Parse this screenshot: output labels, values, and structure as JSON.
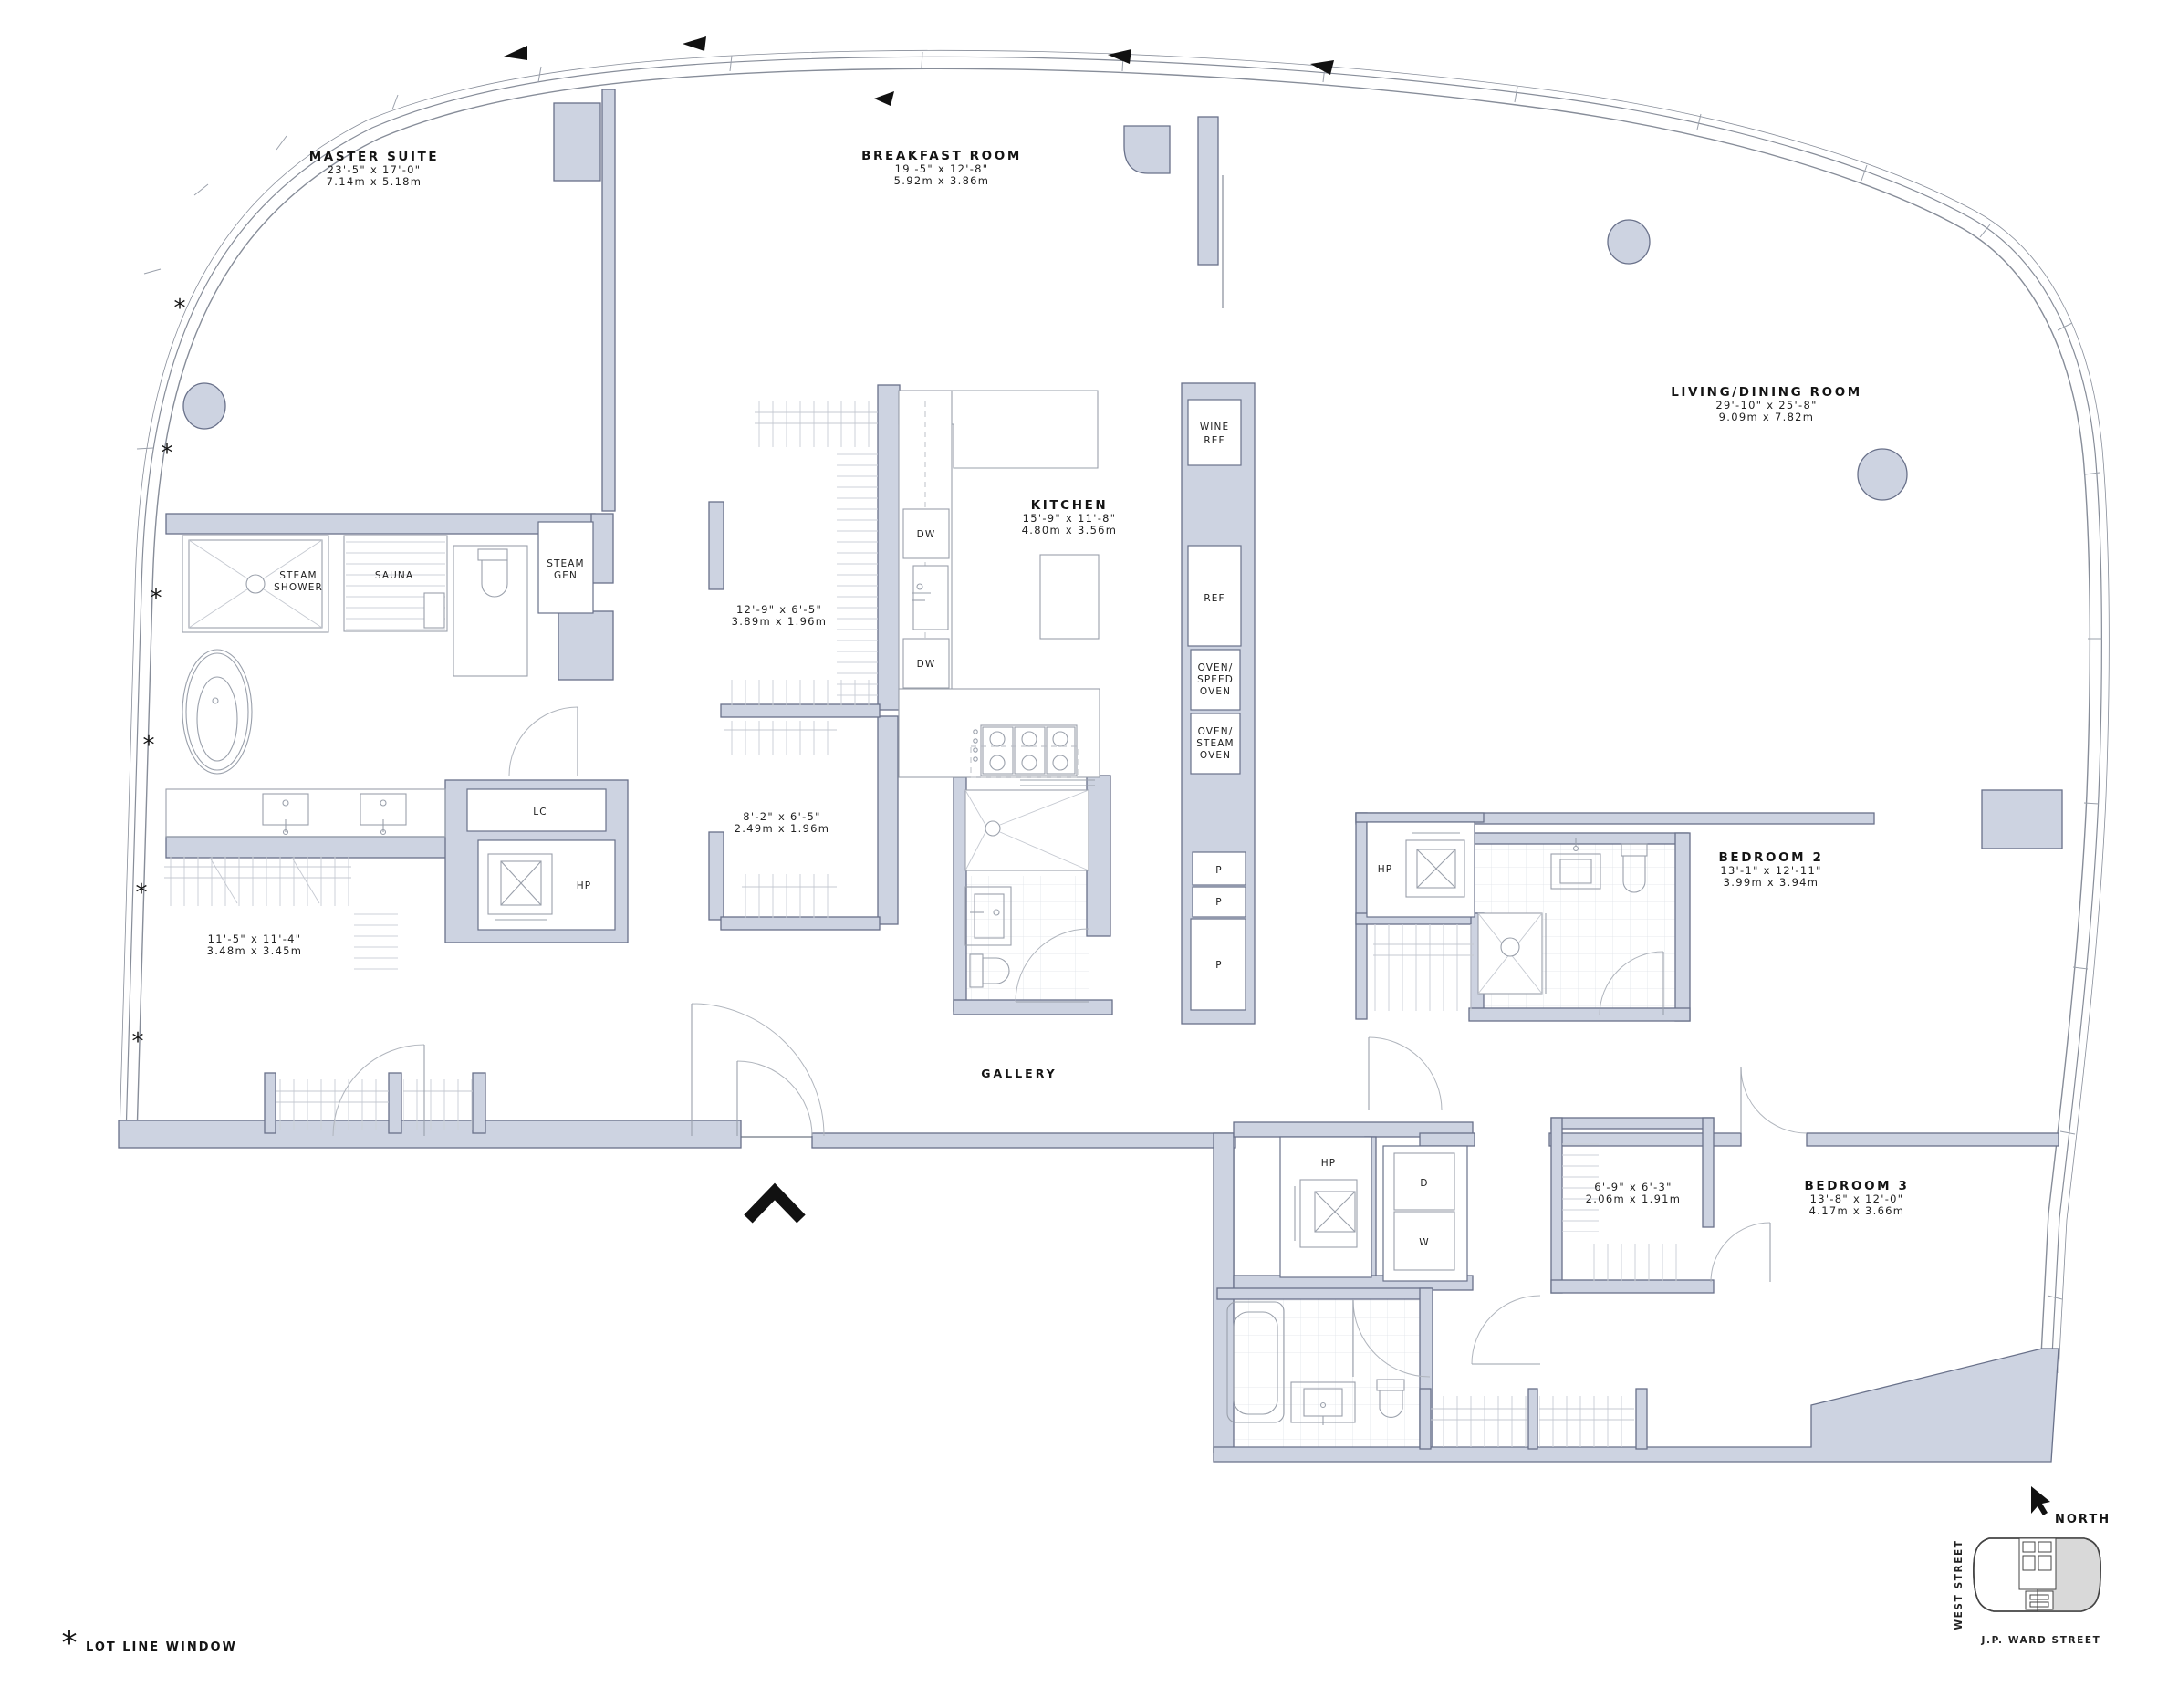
{
  "rooms": {
    "master_suite": {
      "name": "MASTER SUITE",
      "imperial": "23'-5\" x 17'-0\"",
      "metric": "7.14m x 5.18m"
    },
    "breakfast_room": {
      "name": "BREAKFAST ROOM",
      "imperial": "19'-5\" x 12'-8\"",
      "metric": "5.92m x 3.86m"
    },
    "living_dining": {
      "name": "LIVING/DINING ROOM",
      "imperial": "29'-10\" x 25'-8\"",
      "metric": "9.09m x 7.82m"
    },
    "kitchen": {
      "name": "KITCHEN",
      "imperial": "15'-9\" x 11'-8\"",
      "metric": "4.80m x 3.56m"
    },
    "closet_1": {
      "imperial": "12'-9\" x 6'-5\"",
      "metric": "3.89m x 1.96m"
    },
    "closet_2": {
      "imperial": "8'-2\" x 6'-5\"",
      "metric": "2.49m x 1.96m"
    },
    "walk_in_closet": {
      "imperial": "11'-5\" x 11'-4\"",
      "metric": "3.48m x 3.45m"
    },
    "bedroom_2": {
      "name": "BEDROOM 2",
      "imperial": "13'-1\" x 12'-11\"",
      "metric": "3.99m x 3.94m"
    },
    "bedroom_3": {
      "name": "BEDROOM 3",
      "imperial": "13'-8\" x 12'-0\"",
      "metric": "4.17m x 3.66m"
    },
    "bedroom_3_closet": {
      "imperial": "6'-9\" x 6'-3\"",
      "metric": "2.06m x 1.91m"
    },
    "gallery": {
      "name": "GALLERY"
    }
  },
  "fixtures": {
    "steam_shower_line1": "STEAM",
    "steam_shower_line2": "SHOWER",
    "sauna": "SAUNA",
    "steam_gen_line1": "STEAM",
    "steam_gen_line2": "GEN",
    "linen_closet": "LC",
    "elevator": "HP",
    "wine_ref_line1": "WINE",
    "wine_ref_line2": "REF",
    "refrigerator": "REF",
    "oven_speed_line1": "OVEN/",
    "oven_speed_line2": "SPEED",
    "oven_speed_line3": "OVEN",
    "oven_steam_line1": "OVEN/",
    "oven_steam_line2": "STEAM",
    "oven_steam_line3": "OVEN",
    "dishwasher": "DW",
    "pantry": "P",
    "dryer": "D",
    "washer": "W"
  },
  "key_plan": {
    "north_label": "NORTH",
    "west_street_label": "WEST STREET",
    "jp_ward_street_label": "J.P. WARD STREET"
  },
  "legend": {
    "asterisk": "*",
    "lot_line_window_note": "LOT LINE WINDOW"
  },
  "colors": {
    "wall_fill": "#cdd3e1",
    "wall_stroke": "#69718a",
    "floor_hatch": "#e7e9ee",
    "fixture_line": "#9aa0ab",
    "text": "#111111",
    "keyplan_shade": "#d9d9d9"
  }
}
